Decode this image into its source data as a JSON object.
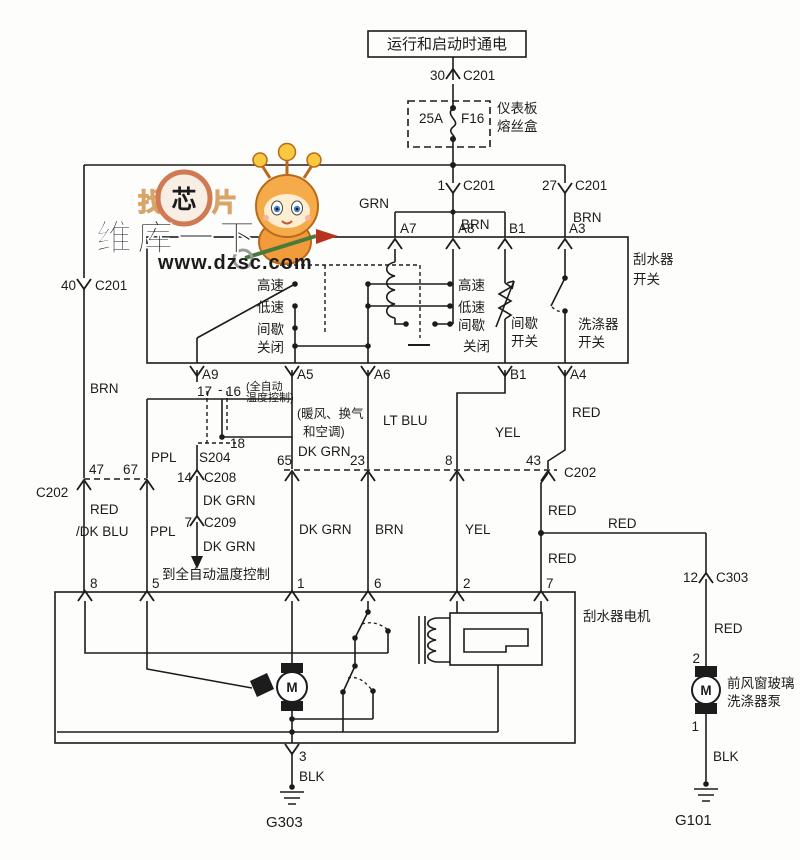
{
  "accent_colors": {
    "line": "#1c1c1c",
    "watermark_orange": "#ea4e1e",
    "watermark_gray": "#8e8e8e",
    "mascot_orange": "#f29b3b"
  },
  "power_feed": {
    "source": "运行和启动时通电",
    "pin": "30",
    "connector": "C201"
  },
  "fuse": {
    "rating": "25A",
    "name": "F16",
    "box_line1": "仪表板",
    "box_line2": "熔丝盒"
  },
  "c201_left": {
    "pin": "40",
    "connector": "C201",
    "wire": "BRN"
  },
  "c201_mid": {
    "pin": "1",
    "connector": "C201",
    "wire_left": "GRN",
    "wire_right": "BRN"
  },
  "c201_right": {
    "pin": "27",
    "connector": "C201",
    "wire": "BRN"
  },
  "wiper_switch": {
    "name_line1": "刮水器",
    "name_line2": "开关",
    "terminals_top": [
      "A7",
      "A8",
      "B1",
      "A3"
    ],
    "terminals_bottom": [
      "A9",
      "A5",
      "A6",
      "B1",
      "A4"
    ],
    "positions_left": [
      "高速",
      "低速",
      "间歇",
      "关闭"
    ],
    "positions_right": [
      "高速",
      "低速",
      "间歇",
      "关闭"
    ],
    "intermittent_line1": "间歇",
    "intermittent_line2": "开关",
    "washer_line1": "洗涤器",
    "washer_line2": "开关"
  },
  "splice": {
    "pin17": "17",
    "dash": "-",
    "pin16": "16",
    "pin18": "18",
    "name": "S204",
    "note_line1": "(全自动",
    "note_line2": "温度控制)"
  },
  "hvac_note": {
    "line1": "(暖风、换气",
    "line2": "和空调)"
  },
  "c202_left": {
    "name": "C202",
    "pin_a": "47",
    "pin_b": "67"
  },
  "c202_right": {
    "name": "C202",
    "pins": [
      "65",
      "23",
      "8",
      "43"
    ]
  },
  "c208": {
    "pin": "14",
    "name": "C208",
    "wire": "DK GRN"
  },
  "c209": {
    "pin": "7",
    "name": "C209",
    "wire": "DK GRN",
    "dest": "到全自动温度控制"
  },
  "wires": {
    "brn_left": "BRN",
    "ppl_upper": "PPL",
    "ppl_lower": "PPL",
    "red_dkblu_1": "RED",
    "red_dkblu_2": "/DK BLU",
    "dkgrn_upper": "DK GRN",
    "dkgrn_lower": "DK GRN",
    "ltblu": "LT BLU",
    "yel_upper": "YEL",
    "yel_lower": "YEL",
    "brn_lower": "BRN",
    "red_upper": "RED",
    "red_mid": "RED",
    "red_low": "RED",
    "red_branch": "RED"
  },
  "wiper_motor": {
    "label": "刮水器电机",
    "terminals_top": [
      "8",
      "5",
      "1",
      "6",
      "2",
      "7"
    ],
    "terminal_bottom": "3",
    "motor_letter": "M"
  },
  "washer_pump": {
    "pin_conn": "12",
    "connector": "C303",
    "wire_in": "RED",
    "pin_top": "2",
    "pin_bottom": "1",
    "label_line1": "前风窗玻璃",
    "label_line2": "洗涤器泵",
    "motor_letter": "M",
    "wire_out": "BLK",
    "ground": "G101"
  },
  "ground_left": {
    "wire": "BLK",
    "name": "G303"
  },
  "watermark": {
    "logo_c1": "找",
    "logo_c2": "芯",
    "logo_c3": "片",
    "brand": "维库一下",
    "url": "www.dzsc.com"
  }
}
